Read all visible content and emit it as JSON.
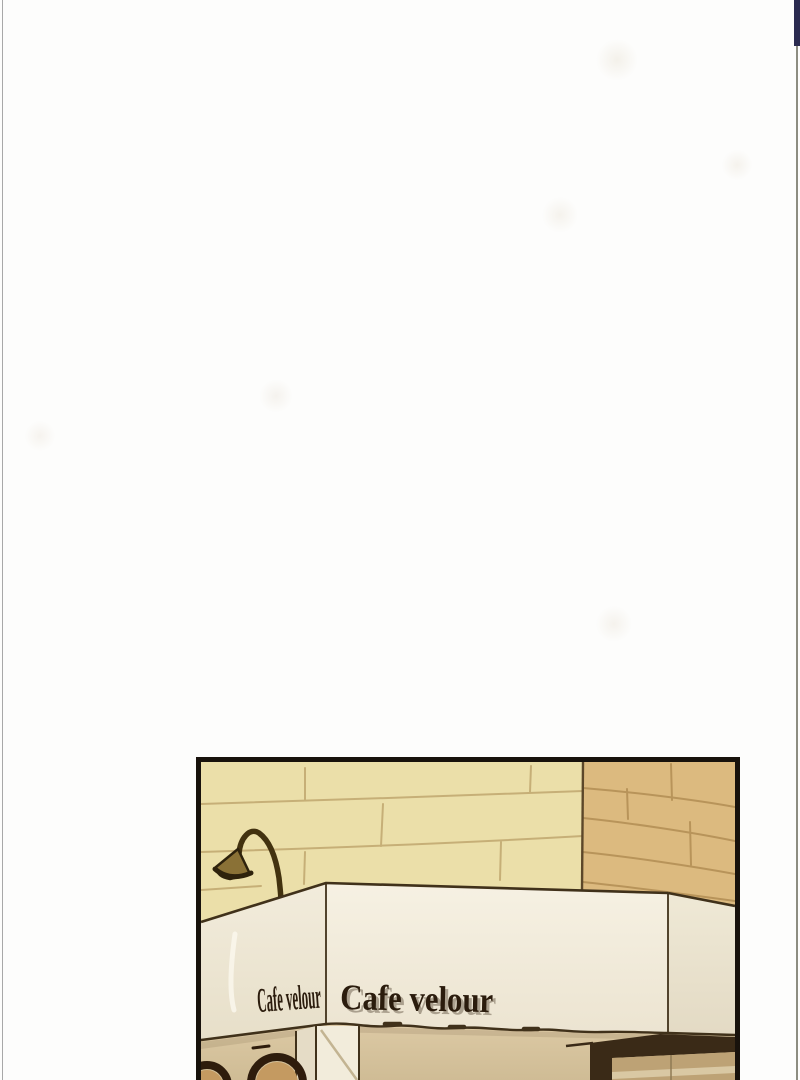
{
  "page": {
    "background": "#fdfdfc",
    "edge_left_color": "#a8a8a8",
    "edge_right_color": "#8d8d81",
    "accent_top_right_color": "#2b2b50"
  },
  "panel": {
    "border_color": "#18120c",
    "sign": {
      "front_text": "Cafe velour",
      "side_text": "Cafe velour",
      "text_color": "#2b1c0d",
      "text_shadow_color": "rgba(45,28,12,0.35)"
    },
    "colors": {
      "tile_light": "#ebdfa9",
      "tile_light_grout": "#c6af77",
      "tile_dark": "#dcba7f",
      "tile_dark_grout": "#b8945a",
      "wall_corner_line": "#5c4729",
      "outline": "#40311a",
      "lamp_arm": "#42320f",
      "lamp_shade": "#8a7136",
      "lamp_shade_rim": "#2e220c",
      "under_wall": "#dcc9a4",
      "arch_stroke": "#2e1c0c",
      "arch_inner": "#c49a61",
      "display_frame": "#3a2a17",
      "display_panel": "#bda275",
      "display_panel_light": "#d9c8a3",
      "pillar_left_face": "#e5dcc6",
      "pillar_front_face": "#f2ecdb"
    }
  }
}
